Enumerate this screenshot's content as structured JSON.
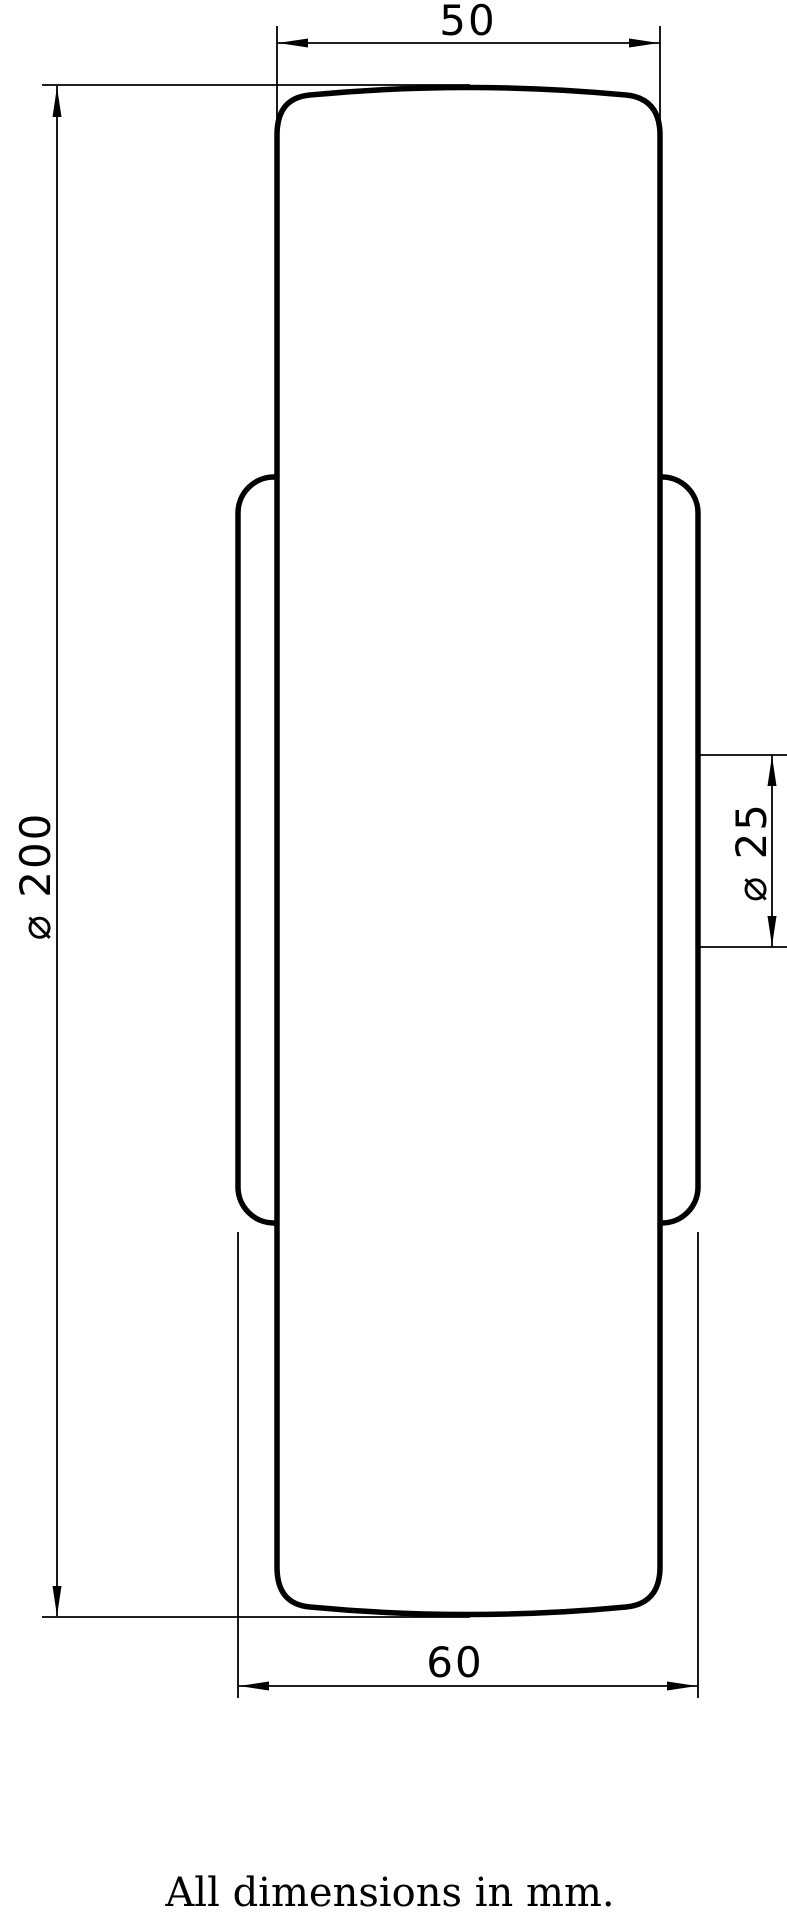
{
  "drawing": {
    "type": "engineering-drawing",
    "subject": "wheel-side-profile",
    "dimensions": {
      "tread_width": "50",
      "wheel_diameter": "⌀ 200",
      "bore_diameter": "⌀ 25",
      "hub_width": "60"
    },
    "note": "All dimensions in mm.",
    "colors": {
      "line": "#000000",
      "background": "#ffffff"
    }
  }
}
